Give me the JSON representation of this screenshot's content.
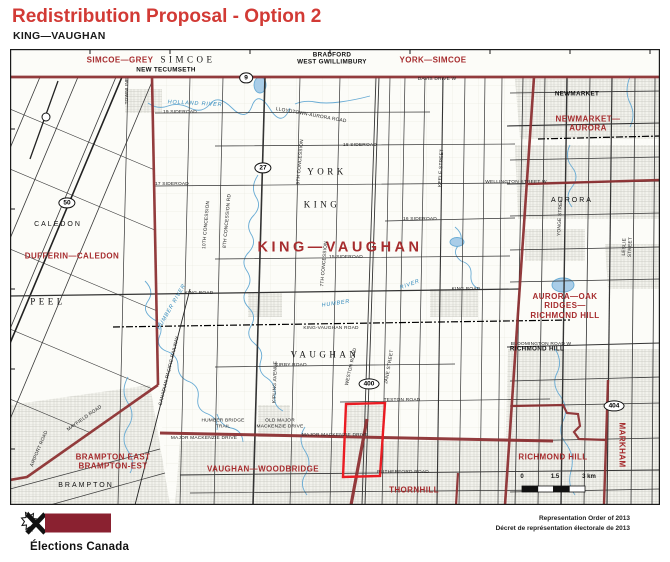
{
  "header": {
    "title": "Redistribution Proposal - Option 2",
    "subtitle": "KING—VAUGHAN"
  },
  "colors": {
    "title_red": "#d23a35",
    "district_label_red": "#a62c2e",
    "boundary_maroon": "#8d3133",
    "proposal_outline_red": "#ea1c23",
    "water_blue": "#68abd4",
    "logo_maroon": "#8a2130"
  },
  "map": {
    "labels": [
      {
        "t": "SIMCOE—GREY",
        "x": 110,
        "y": 11,
        "cls": "d",
        "name": "district-label-simcoe-grey"
      },
      {
        "t": "YORK—SIMCOE",
        "x": 423,
        "y": 11,
        "cls": "d",
        "name": "district-label-york-simcoe"
      },
      {
        "t": "DUFFERIN—CALEDON",
        "x": 62,
        "y": 207,
        "cls": "d",
        "name": "district-label-dufferin-caledon"
      },
      {
        "t": "NEWMARKET—\nAURORA",
        "x": 578,
        "y": 75,
        "cls": "d",
        "name": "district-label-newmarket-aurora"
      },
      {
        "t": "AURORA—OAK RIDGES—\nRICHMOND HILL",
        "x": 555,
        "y": 257,
        "cls": "d",
        "name": "district-label-aurora-oak-ridges-richmond-hill"
      },
      {
        "t": "BRAMPTON EAST\nBRAMPTON-EST",
        "x": 103,
        "y": 413,
        "cls": "d",
        "name": "district-label-brampton-east"
      },
      {
        "t": "VAUGHAN—WOODBRIDGE",
        "x": 253,
        "y": 420,
        "cls": "d",
        "name": "district-label-vaughan-woodbridge"
      },
      {
        "t": "THORNHILL",
        "x": 404,
        "y": 441,
        "cls": "d",
        "name": "district-label-thornhill"
      },
      {
        "t": "RICHMOND HILL",
        "x": 543,
        "y": 408,
        "cls": "d",
        "name": "district-label-richmond-hill"
      },
      {
        "t": "MARKHAM",
        "x": 612,
        "y": 396,
        "rot": 90,
        "cls": "d",
        "name": "district-label-markham"
      },
      {
        "t": "KING—VAUGHAN",
        "x": 330,
        "y": 199,
        "cls": "dbig",
        "name": "district-label-king-vaughan"
      },
      {
        "t": "YORK",
        "x": 317,
        "y": 123,
        "cls": "ps",
        "name": "region-label-york"
      },
      {
        "t": "KING",
        "x": 312,
        "y": 156,
        "cls": "ps",
        "name": "region-label-king"
      },
      {
        "t": "VAUGHAN",
        "x": 315,
        "y": 306,
        "cls": "ps",
        "name": "region-label-vaughan"
      },
      {
        "t": "PEEL",
        "x": 38,
        "y": 253,
        "cls": "ps",
        "name": "region-label-peel"
      },
      {
        "t": "SIMCOE",
        "x": 178,
        "y": 11,
        "cls": "ps",
        "name": "region-label-simcoe"
      },
      {
        "t": "CALEDON",
        "x": 48,
        "y": 176,
        "cls": "p",
        "name": "town-label-caledon"
      },
      {
        "t": "BRAMPTON",
        "x": 76,
        "y": 437,
        "cls": "p",
        "name": "town-label-brampton"
      },
      {
        "t": "AURORA",
        "x": 562,
        "y": 152,
        "cls": "p",
        "name": "town-label-aurora"
      },
      {
        "t": "NEW TECUMSETH",
        "x": 156,
        "y": 21,
        "cls": "t",
        "name": "town-label-new-tecumseth"
      },
      {
        "t": "BRADFORD\nWEST GWILLIMBURY",
        "x": 322,
        "y": 10,
        "cls": "t",
        "name": "town-label-bradford-west-gwillimbury"
      },
      {
        "t": "NEWMARKET",
        "x": 567,
        "y": 45,
        "cls": "t",
        "name": "town-label-newmarket"
      },
      {
        "t": "RICHMOND HILL",
        "x": 527,
        "y": 300,
        "cls": "t",
        "name": "town-label-richmond-hill-black"
      },
      {
        "t": "19 SIDEROAD",
        "x": 170,
        "y": 64,
        "cls": "r"
      },
      {
        "t": "LLOYDTOWN-AURORA ROAD",
        "x": 301,
        "y": 67,
        "rot": 10,
        "cls": "r"
      },
      {
        "t": "DAVIS DRIVE W",
        "x": 427,
        "y": 31,
        "cls": "r"
      },
      {
        "t": "18 SIDEROAD",
        "x": 350,
        "y": 97,
        "cls": "r"
      },
      {
        "t": "17 SIDEROAD",
        "x": 162,
        "y": 136,
        "cls": "r"
      },
      {
        "t": "16 SIDEROAD",
        "x": 410,
        "y": 171,
        "cls": "r"
      },
      {
        "t": "15 SIDEROAD",
        "x": 336,
        "y": 209,
        "cls": "r"
      },
      {
        "t": "KING ROAD",
        "x": 189,
        "y": 245,
        "cls": "r"
      },
      {
        "t": "KING ROAD",
        "x": 456,
        "y": 241,
        "cls": "r"
      },
      {
        "t": "KING-VAUGHAN ROAD",
        "x": 321,
        "y": 280,
        "cls": "r"
      },
      {
        "t": "KIRBY ROAD",
        "x": 281,
        "y": 317,
        "cls": "r"
      },
      {
        "t": "TESTON ROAD",
        "x": 392,
        "y": 352,
        "cls": "r"
      },
      {
        "t": "MAJOR MACKENZIE DRIVE",
        "x": 194,
        "y": 390,
        "cls": "r"
      },
      {
        "t": "MAJOR MACKENZIE DRIVE",
        "x": 325,
        "y": 387,
        "cls": "r"
      },
      {
        "t": "RUTHERFORD ROAD",
        "x": 393,
        "y": 424,
        "cls": "r"
      },
      {
        "t": "WELLINGTON STREET W",
        "x": 506,
        "y": 134,
        "cls": "r"
      },
      {
        "t": "BLOOMINGTON ROAD W",
        "x": 531,
        "y": 296,
        "cls": "r"
      },
      {
        "t": "HUMBER BRIDGE\nTRAIL",
        "x": 213,
        "y": 375,
        "cls": "r"
      },
      {
        "t": "OLD MAJOR\nMACKENZIE DRIVE",
        "x": 270,
        "y": 375,
        "cls": "r"
      },
      {
        "t": "MAYFIELD ROAD",
        "x": 75,
        "y": 370,
        "rot": -35,
        "cls": "r"
      },
      {
        "t": "AIRPORT ROAD",
        "x": 30,
        "y": 400,
        "rot": -67,
        "cls": "r"
      },
      {
        "t": "CANADIAN PACIFIC RAILWAY",
        "x": 160,
        "y": 322,
        "rot": -76,
        "cls": "r"
      },
      {
        "t": "TOWNLINE",
        "x": 118,
        "y": 42,
        "rot": -90,
        "cls": "r"
      },
      {
        "t": "10TH CONCESSION",
        "x": 197,
        "y": 176,
        "rot": -85,
        "cls": "r"
      },
      {
        "t": "8TH CONCESSION RD",
        "x": 218,
        "y": 172,
        "rot": -85,
        "cls": "r"
      },
      {
        "t": "9TH CONCESSION",
        "x": 291,
        "y": 113,
        "rot": -85,
        "cls": "r"
      },
      {
        "t": "7TH CONCESSION",
        "x": 315,
        "y": 215,
        "rot": -85,
        "cls": "r"
      },
      {
        "t": "KEELE STREET",
        "x": 432,
        "y": 119,
        "rot": -87,
        "cls": "r"
      },
      {
        "t": "KIPLING AVENUE",
        "x": 266,
        "y": 333,
        "rot": -88,
        "cls": "r"
      },
      {
        "t": "WESTON ROAD",
        "x": 342,
        "y": 318,
        "rot": -77,
        "cls": "r"
      },
      {
        "t": "JANE STREET",
        "x": 380,
        "y": 318,
        "rot": -80,
        "cls": "r"
      },
      {
        "t": "YONGE STREET",
        "x": 551,
        "y": 167,
        "rot": -87,
        "cls": "r"
      },
      {
        "t": "LESLIE STREET",
        "x": 618,
        "y": 198,
        "rot": -87,
        "cls": "r"
      },
      {
        "t": "HOLLAND RIVER",
        "x": 185,
        "y": 55,
        "rot": 3,
        "cls": "w",
        "name": "water-label-holland-river"
      },
      {
        "t": "HUMBER",
        "x": 326,
        "y": 255,
        "rot": -8,
        "cls": "w",
        "name": "water-label-humber"
      },
      {
        "t": "RIVER",
        "x": 400,
        "y": 236,
        "rot": -20,
        "cls": "w",
        "name": "water-label-river"
      },
      {
        "t": "HUMBER RIVER",
        "x": 162,
        "y": 258,
        "rot": -60,
        "cls": "w",
        "name": "water-label-humber-river"
      }
    ],
    "shields": [
      {
        "n": "9",
        "x": 236,
        "y": 29
      },
      {
        "n": "27",
        "x": 253,
        "y": 119
      },
      {
        "n": "50",
        "x": 57,
        "y": 154
      },
      {
        "n": "400",
        "x": 359,
        "y": 335
      },
      {
        "n": "404",
        "x": 604,
        "y": 357
      }
    ],
    "scale": {
      "y": 431,
      "labels": [
        {
          "t": "0",
          "x": 512
        },
        {
          "t": "1.5",
          "x": 545
        },
        {
          "t": "3 km",
          "x": 579
        }
      ]
    }
  },
  "footer": {
    "logo_text": "Élections Canada",
    "credit_en": "Representation Order of 2013",
    "credit_fr": "Décret de représentation électorale de 2013"
  }
}
